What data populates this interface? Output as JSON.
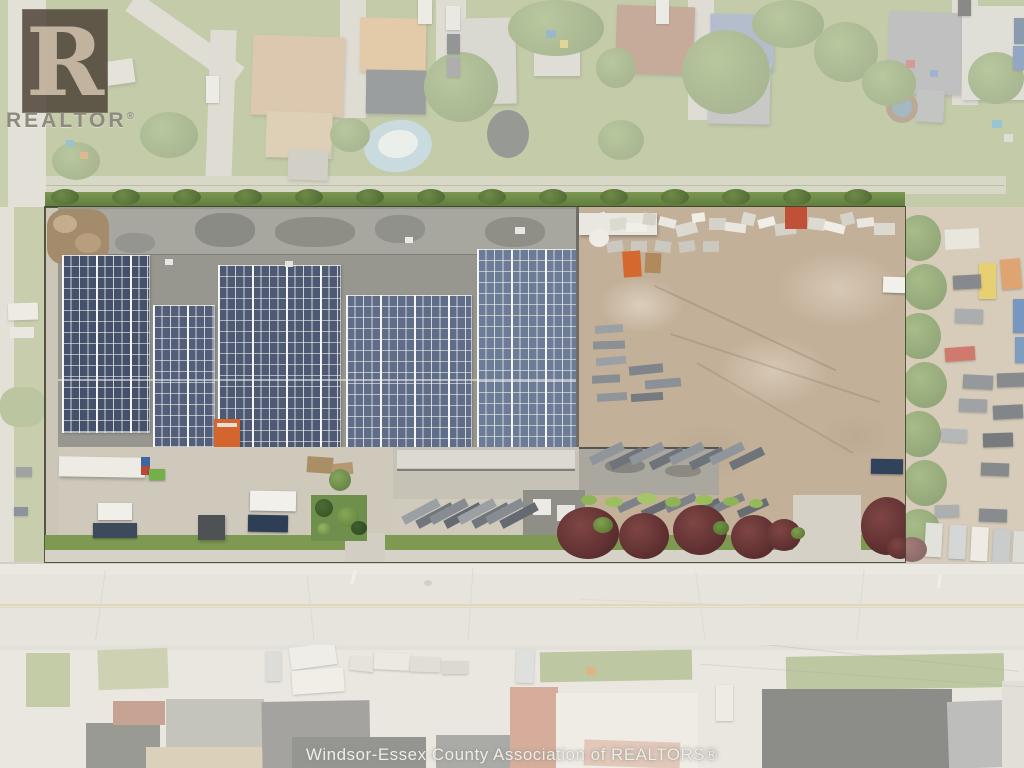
{
  "watermark": {
    "letter": "R",
    "label": "REALTOR",
    "reg": "®"
  },
  "caption": "Windsor-Essex County Association of REALTORS®",
  "palette": {
    "solar_panel": "#4e5a74",
    "roof_concrete": "#97978f",
    "yard_dirt": "#c3b099",
    "grass": "#96ab6b",
    "maroon_tree": "#6f3d3c",
    "road": "#dfdcd5",
    "boundary_line": "#3e402e",
    "dumpster_orange": "#d4652f"
  }
}
